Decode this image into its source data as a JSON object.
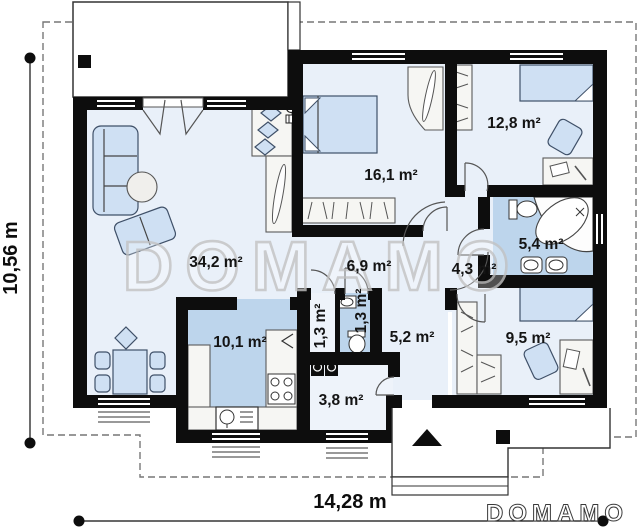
{
  "plan": {
    "watermark": "DOMAMO",
    "logo": "DOMAMO",
    "dimensions": {
      "overall_width": "14,28 m",
      "overall_height": "10,56 m"
    },
    "rooms": [
      {
        "key": "living-room",
        "area": "34,2 m²"
      },
      {
        "key": "bedroom-1",
        "area": "16,1 m²"
      },
      {
        "key": "bedroom-2",
        "area": "12,8 m²"
      },
      {
        "key": "bathroom",
        "area": "5,4 m²"
      },
      {
        "key": "corridor",
        "area": "6,9 m²"
      },
      {
        "key": "hall",
        "area": "4,3 m²"
      },
      {
        "key": "kitchen",
        "area": "10,1 m²"
      },
      {
        "key": "pantry",
        "area": "1,3 m²"
      },
      {
        "key": "wc",
        "area": "1,3 m²"
      },
      {
        "key": "entry-hall",
        "area": "5,2 m²"
      },
      {
        "key": "bedroom-3",
        "area": "9,5 m²"
      },
      {
        "key": "utility-room",
        "area": "3,8 m²"
      }
    ],
    "colors": {
      "wall": "#0d0d0d",
      "floor_light": "#e9f0f9",
      "floor_blue": "#bdd5ec",
      "furniture_blue": "#cfe0f3",
      "furniture_outline": "#3f5068",
      "watermark_gray": "#c3c3c3"
    }
  }
}
